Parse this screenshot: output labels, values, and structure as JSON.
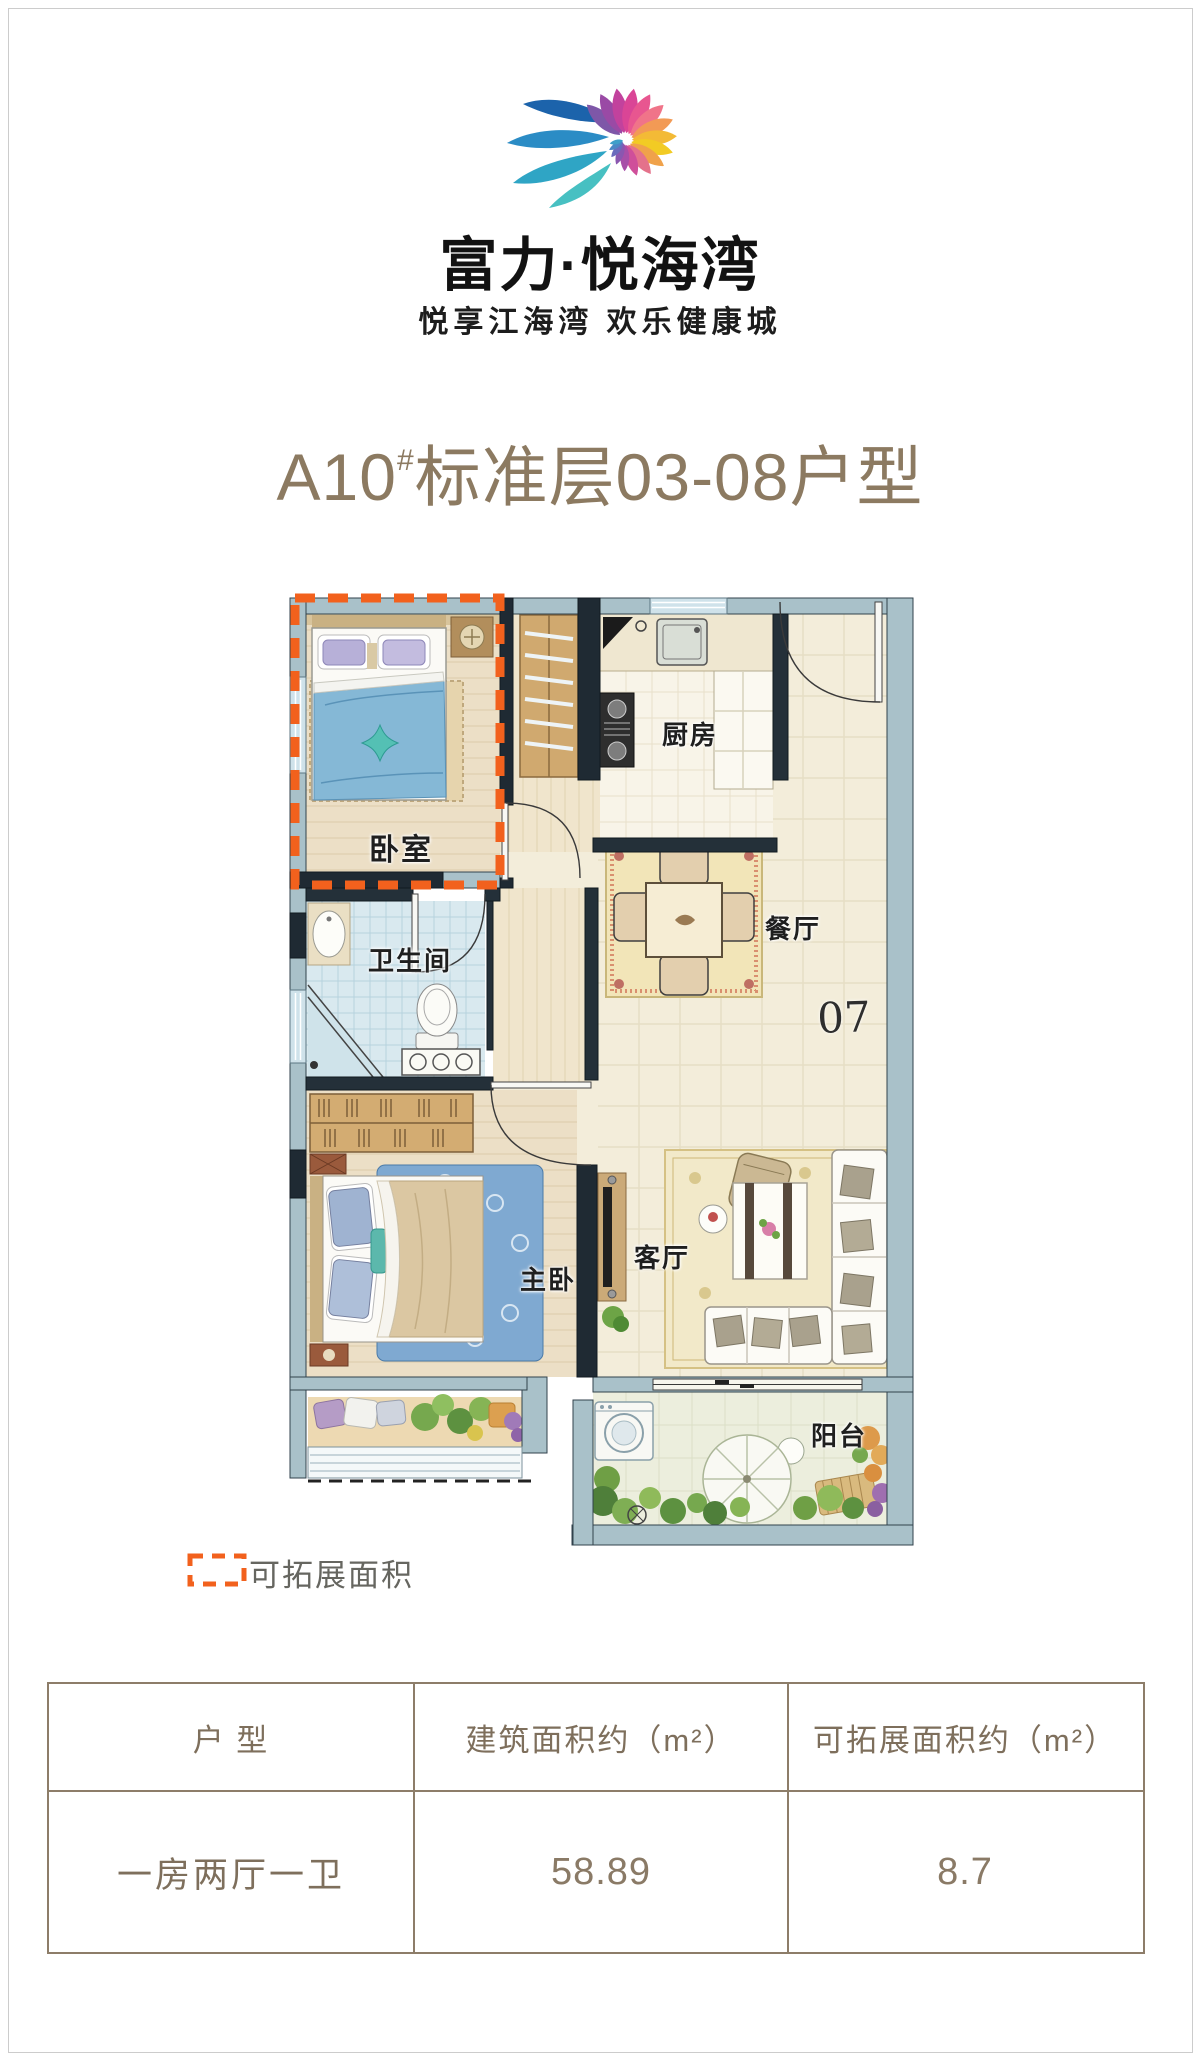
{
  "brand": {
    "name": "富力·悦海湾",
    "tagline": "悦享江海湾  欢乐健康城"
  },
  "title": {
    "prefix": "A10",
    "hash": "#",
    "suffix": "标准层03-08户型"
  },
  "floorplan": {
    "labels": {
      "bedroom": "卧室",
      "kitchen": "厨房",
      "dining": "餐厅",
      "bathroom": "卫生间",
      "master_bedroom": "主卧",
      "living_room": "客厅",
      "balcony": "阳台"
    },
    "unit_number": "07"
  },
  "legend": {
    "label": "可拓展面积"
  },
  "spec_table": {
    "headers": [
      "户  型",
      "建筑面积约（m²）",
      "可拓展面积约（m²）"
    ],
    "row": {
      "unit_type": "一房两厅一卫",
      "build_area": "58.89",
      "expand_area": "8.7"
    }
  },
  "colors": {
    "accent_orange": "#f2611d",
    "title_brown": "#8c7a61",
    "table_border": "#8d7d69",
    "wall_dark": "#1f2a33",
    "wall_light": "#a9c1c9"
  }
}
